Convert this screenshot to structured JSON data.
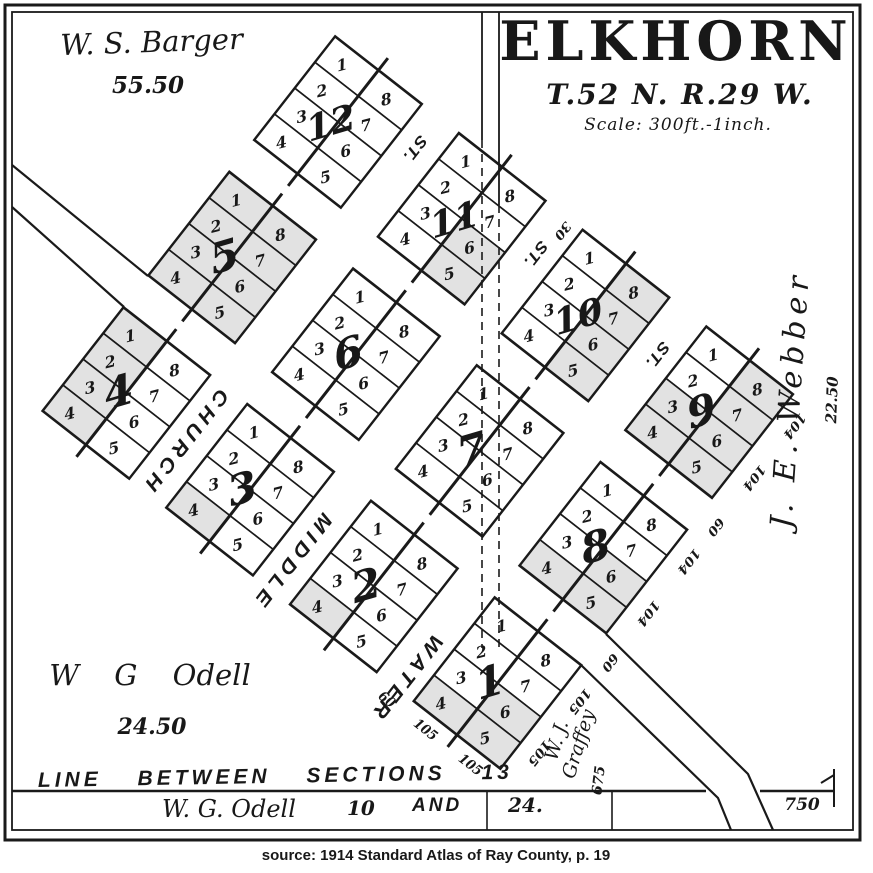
{
  "title": {
    "name": "ELKHORN",
    "township": "T.52 N. R.29 W.",
    "scale": "Scale: 300ft.-1inch."
  },
  "owners": {
    "barger": {
      "name": "W. S. Barger",
      "acres": "55.50"
    },
    "odell_nw": {
      "name": "W G Odell",
      "acres": "24.50"
    },
    "webber": {
      "name": "J. E. Webber",
      "acres": "22.50"
    },
    "graffey": {
      "line1": "W. J.",
      "line2": "Graffey"
    },
    "odell_strip": {
      "name": "W. G. Odell",
      "section": "10"
    }
  },
  "section_line": {
    "label": "LINE BETWEEN SECTIONS 13",
    "and": "AND",
    "south": "24.",
    "dim_675": "675",
    "dim_750": "750"
  },
  "plat": {
    "lot_numbers_left": [
      "1",
      "2",
      "3",
      "4"
    ],
    "lot_numbers_right": [
      "8",
      "7",
      "6",
      "5"
    ],
    "street_end_label": "ST.",
    "streets": [
      {
        "name": "CHURCH"
      },
      {
        "name": "MIDDLE"
      },
      {
        "name": "WATER"
      }
    ],
    "blocks": [
      {
        "number": "12",
        "row": 0,
        "col": 0,
        "shaded": []
      },
      {
        "number": "11",
        "row": 0,
        "col": 1,
        "shaded": [
          "5",
          "6"
        ]
      },
      {
        "number": "10",
        "row": 0,
        "col": 2,
        "shaded": [
          "5",
          "6",
          "7",
          "8"
        ]
      },
      {
        "number": "9",
        "row": 0,
        "col": 3,
        "shaded": [
          "3",
          "4",
          "5",
          "6",
          "7",
          "8"
        ]
      },
      {
        "number": "5",
        "row": 1,
        "col": 0,
        "shaded": [
          "1",
          "2",
          "3",
          "4",
          "5",
          "6",
          "7",
          "8"
        ]
      },
      {
        "number": "6",
        "row": 1,
        "col": 1,
        "shaded": []
      },
      {
        "number": "7",
        "row": 1,
        "col": 2,
        "shaded": []
      },
      {
        "number": "8",
        "row": 1,
        "col": 3,
        "shaded": [
          "4",
          "5",
          "6"
        ]
      },
      {
        "number": "4",
        "row": 2,
        "col": 0,
        "shaded": [
          "1",
          "2",
          "3",
          "4"
        ]
      },
      {
        "number": "3",
        "row": 2,
        "col": 1,
        "shaded": [
          "4"
        ]
      },
      {
        "number": "2",
        "row": 2,
        "col": 2,
        "shaded": [
          "4"
        ]
      },
      {
        "number": "1",
        "row": 2,
        "col": 3,
        "shaded": [
          "4",
          "5",
          "6"
        ]
      }
    ],
    "dims": [
      {
        "t": "104",
        "u": 543,
        "v": -38,
        "r": 90
      },
      {
        "t": "104",
        "u": 543,
        "v": 22,
        "r": 90
      },
      {
        "t": "60",
        "u": 543,
        "v": 79,
        "r": 90
      },
      {
        "t": "104",
        "u": 543,
        "v": 119,
        "r": 90
      },
      {
        "t": "104",
        "u": 543,
        "v": 179,
        "r": 90
      },
      {
        "t": "60",
        "u": 543,
        "v": 236,
        "r": 90
      },
      {
        "t": "105",
        "u": 543,
        "v": 281,
        "r": 90
      },
      {
        "t": "105",
        "u": 543,
        "v": 341,
        "r": 90
      },
      {
        "t": "105",
        "u": 443,
        "v": 392,
        "r": 0
      },
      {
        "t": "105",
        "u": 500,
        "v": 392,
        "r": 0
      },
      {
        "t": "60",
        "u": 394,
        "v": 392,
        "r": 0
      },
      {
        "t": "30",
        "u": 240,
        "v": -48,
        "r": 90
      }
    ]
  },
  "caption": "source: 1914 Standard Atlas of Ray County, p. 19",
  "colors": {
    "ink": "#1a1a1a",
    "paper": "#ffffff",
    "shade": "#e2e2e2"
  }
}
